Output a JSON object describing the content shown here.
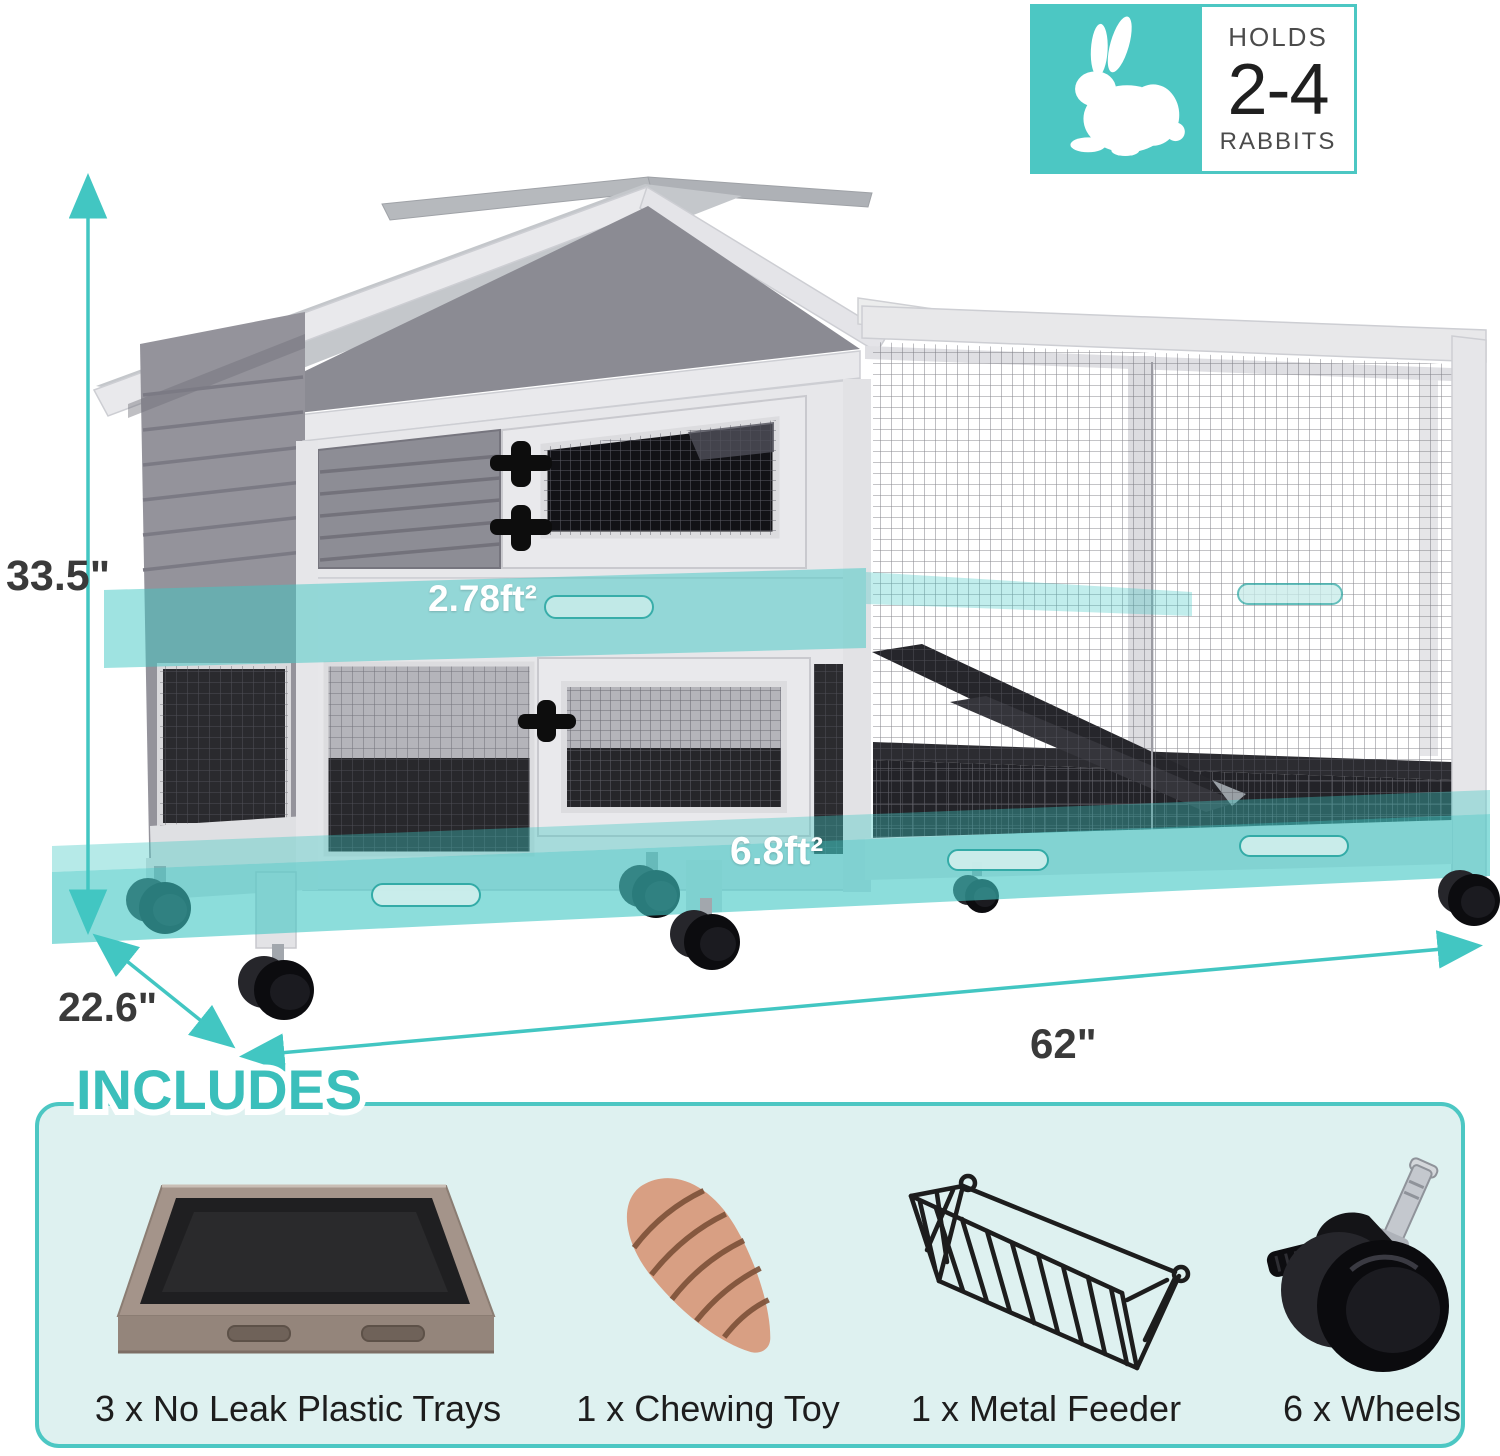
{
  "badge": {
    "holds_label": "HOLDS",
    "count": "2-4",
    "animal_label": "RABBITS",
    "icon": "rabbit-icon"
  },
  "dimensions": {
    "height": "33.5\"",
    "depth": "22.6\"",
    "width": "62\""
  },
  "area_labels": {
    "upper_floor": "2.78ft²",
    "lower_floor": "6.8ft²"
  },
  "includes": {
    "title": "INCLUDES",
    "items": [
      {
        "label": "3 x No Leak Plastic Trays",
        "icon": "plastic-tray-icon"
      },
      {
        "label": "1 x Chewing Toy",
        "icon": "chewing-toy-icon"
      },
      {
        "label": "1 x Metal Feeder",
        "icon": "metal-feeder-icon"
      },
      {
        "label": "6 x Wheels",
        "icon": "caster-wheel-icon"
      }
    ]
  },
  "colors": {
    "accent": "#4cc7c3",
    "band": "#3fc7c3",
    "boxfill": "#def1f0",
    "titleteal": "#3bbfbb"
  }
}
